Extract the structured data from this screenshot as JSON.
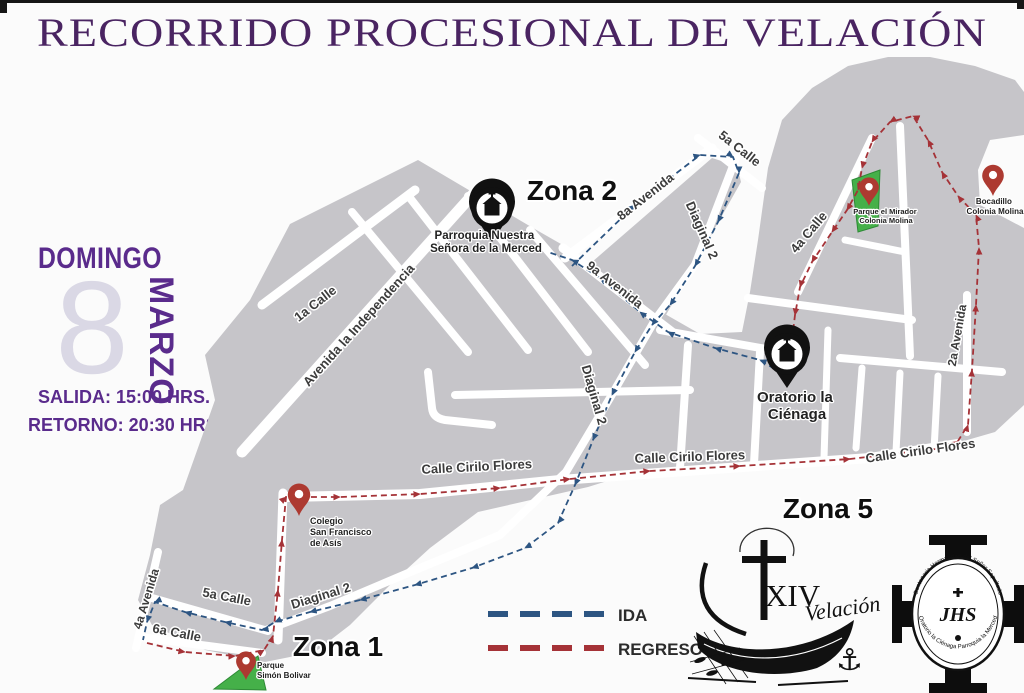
{
  "page": {
    "title": "RECORRIDO PROCESIONAL DE VELACIÓN",
    "title_color": "#4a2462"
  },
  "schedule": {
    "day": "DOMINGO",
    "date_number": "8",
    "month": "MARZO",
    "salida_label": "SALIDA: 15:00 HRS.",
    "retorno_label": "RETORNO: 20:30 HRS."
  },
  "legend": {
    "ida_label": "IDA",
    "regreso_label": "REGRESO",
    "ida_color": "#2d5582",
    "regreso_color": "#a53237"
  },
  "zones": {
    "zona1": "Zona 1",
    "zona2": "Zona 2",
    "zona5": "Zona 5"
  },
  "landmarks": {
    "merced_line1": "Parroquia Nuestra",
    "merced_line2": "Señora de la Merced",
    "oratorio_line1": "Oratorio la",
    "oratorio_line2": "Ciénaga",
    "mirador_line1": "Parque el Mirador",
    "mirador_line2": "Colonia Molina",
    "bocadillo_line1": "Bocadillo",
    "bocadillo_line2": "Colonia Molina",
    "colegio_line1": "Colegio",
    "colegio_line2": "San Francisco",
    "colegio_line3": "de Asís",
    "bolivar_line1": "Parque",
    "bolivar_line2": "Simón Bolivar"
  },
  "streets": {
    "calle_1a": "1a Calle",
    "independencia": "Avenida la Independencia",
    "avenida_8a": "8a Avenida",
    "avenida_9a": "9a Avenida",
    "diaginal_2": "Diaginal 2",
    "calle_5a": "5a Calle",
    "calle_4a": "4a Calle",
    "avenida_2a": "2a Avenida",
    "cirilo_flores": "Calle Cirilo Flores",
    "calle_6a": "6a Calle",
    "avenida_4a": "4a Avenida"
  },
  "logos": {
    "roman_numeral": "XIV",
    "velacion_script": "Velación",
    "anchor_icon": "⚓",
    "seal_monogram": "JHS",
    "seal_text_top": "Centenaria Hermandad del Señor Sepultado",
    "seal_text_bottom": "Oratorio la Ciénaga Parroquia la Merced"
  }
}
